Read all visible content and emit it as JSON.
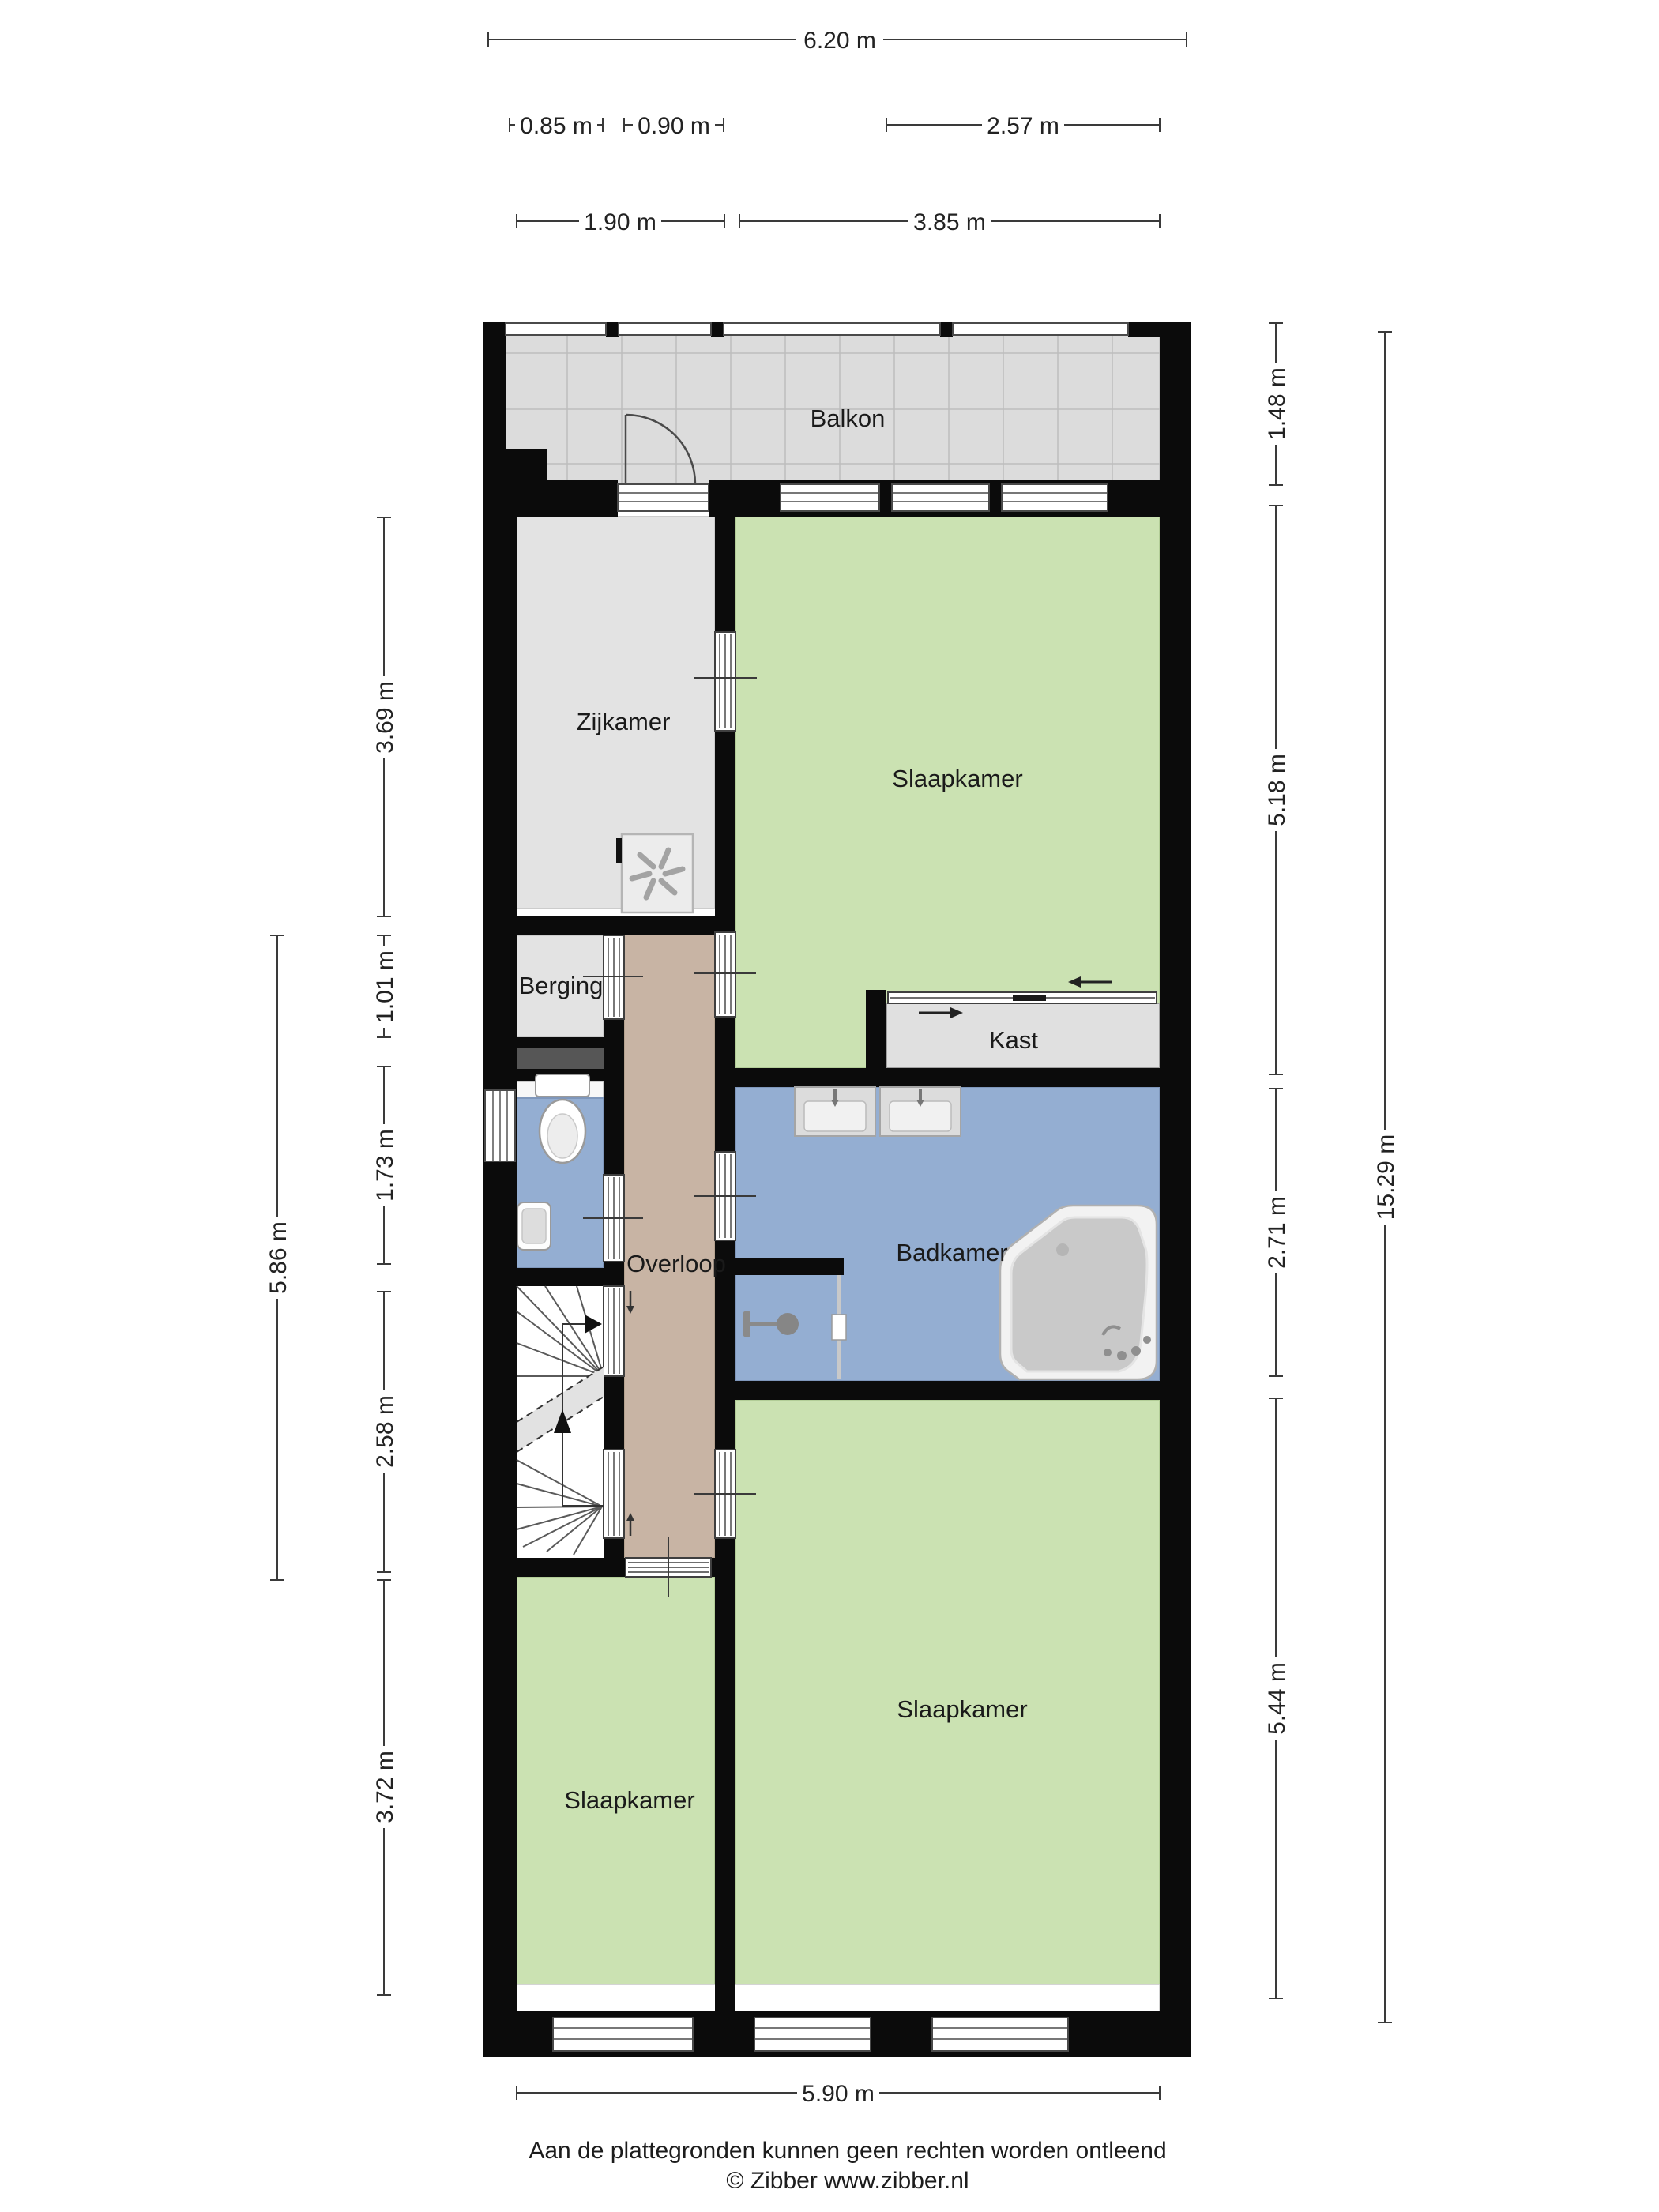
{
  "rooms": {
    "balkon": "Balkon",
    "zijkamer": "Zijkamer",
    "slaapkamer_top": "Slaapkamer",
    "berging": "Berging",
    "kast": "Kast",
    "overloop": "Overloop",
    "badkamer": "Badkamer",
    "slaapkamer_right": "Slaapkamer",
    "slaapkamer_left": "Slaapkamer"
  },
  "dimensions": {
    "top_total": "6.20 m",
    "top_085": "0.85 m",
    "top_090": "0.90 m",
    "top_257": "2.57 m",
    "top_190": "1.90 m",
    "top_385": "3.85 m",
    "right_148": "1.48 m",
    "right_518": "5.18 m",
    "right_271": "2.71 m",
    "right_544": "5.44 m",
    "right_total": "15.29 m",
    "left_369": "3.69 m",
    "left_101": "1.01 m",
    "left_586": "5.86 m",
    "left_173": "1.73 m",
    "left_258": "2.58 m",
    "left_372": "3.72 m",
    "bottom_total": "5.90 m"
  },
  "footer": {
    "disclaimer": "Aan de plattegronden kunnen geen rechten worden ontleend",
    "copyright": "© Zibber www.zibber.nl"
  },
  "colors": {
    "wall": "#0b0b0b",
    "balkon_floor": "#dcdcdc",
    "gray_room": "#e3e3e3",
    "green_room": "#cbe2b2",
    "blue_room": "#94aed2",
    "corridor": "#c8b4a4",
    "kast_floor": "#e0e0e0",
    "dark_strip": "#565656"
  }
}
